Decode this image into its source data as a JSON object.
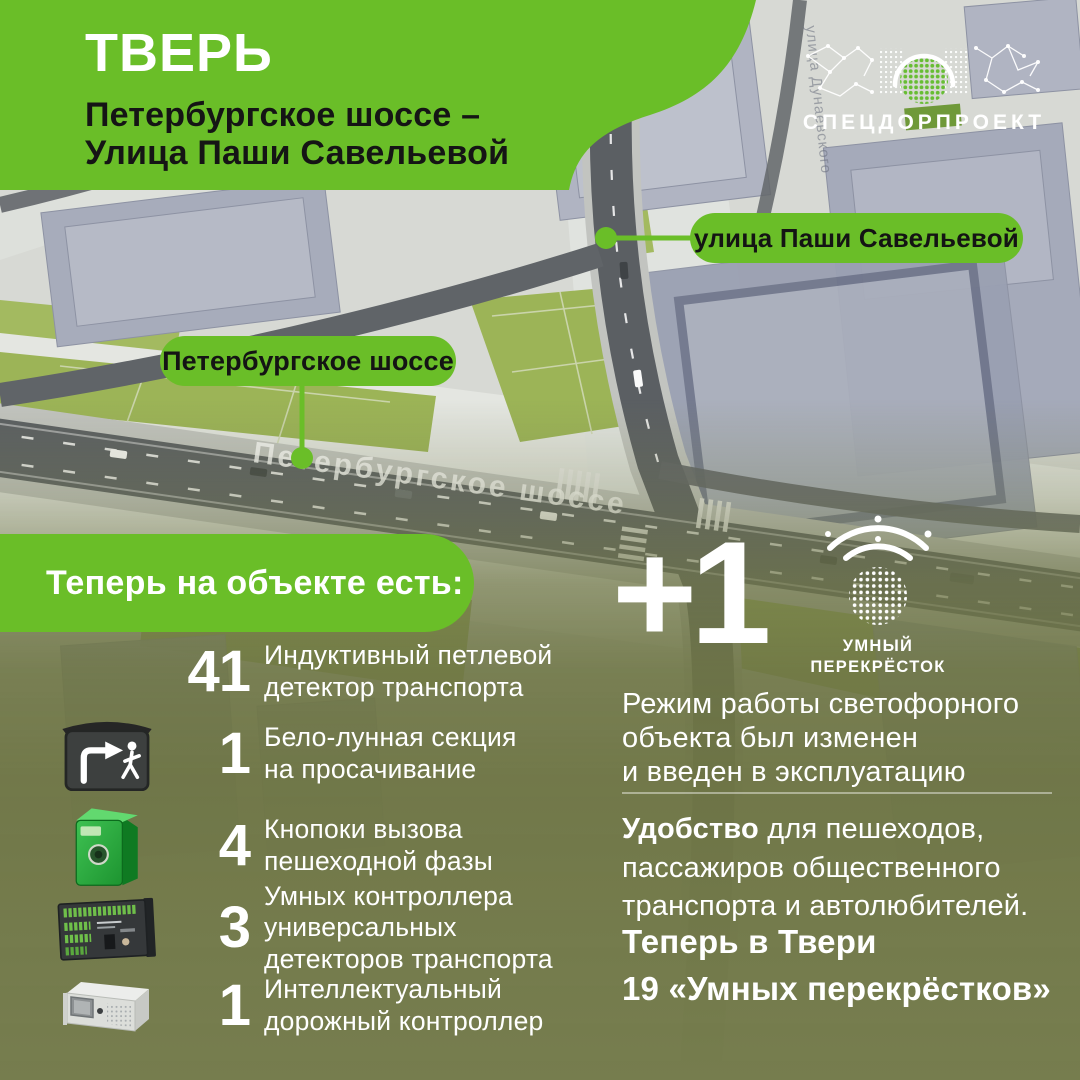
{
  "colors": {
    "accent_green": "#6abe28",
    "overlay_olive": "#767d4e",
    "pill_text": "#141414"
  },
  "header": {
    "city": "ТВЕРЬ",
    "subtitle": "Петербургское шоссе –\nУлица Паши Савельевой"
  },
  "logo": {
    "name": "СПЕЦДОРПРОЕКТ"
  },
  "map": {
    "street_label_top": "улица Паши Савельевой",
    "street_label_left": "Петербургское шоссе",
    "road_surface_text": "Петербургское шоссе",
    "faint_street_text": "улица Дунаевского"
  },
  "banner": {
    "title": "Теперь на объекте есть:"
  },
  "equipment": {
    "items": [
      {
        "count": "41",
        "label": "Индуктивный петлевой\nдетектор транспорта",
        "icon": "none"
      },
      {
        "count": "1",
        "label": "Бело-лунная секция\nна просачивание",
        "icon": "pedestrian-section-icon"
      },
      {
        "count": "4",
        "label": "Кнопоки вызова\nпешеходной фазы",
        "icon": "pedestrian-call-button-icon"
      },
      {
        "count": "3",
        "label": "Умных контроллера\nуниверсальных\nдетекторов транспорта",
        "icon": "detector-controller-icon"
      },
      {
        "count": "1",
        "label": "Интеллектуальный\nдорожный контроллер",
        "icon": "road-controller-icon"
      }
    ]
  },
  "result": {
    "plus": "+1",
    "badge_caption": "УМНЫЙ\nПЕРЕКРЁСТОК",
    "description": "Режим работы светофорного\nобъекта был изменен\nи введен в эксплуатацию",
    "benefit_lead": "Удобство",
    "benefit_rest": " для пешеходов,\nпассажиров общественного\nтранспорта и автолюбителей.",
    "total": "Теперь в Твери\n19 «Умных перекрёстков»"
  }
}
